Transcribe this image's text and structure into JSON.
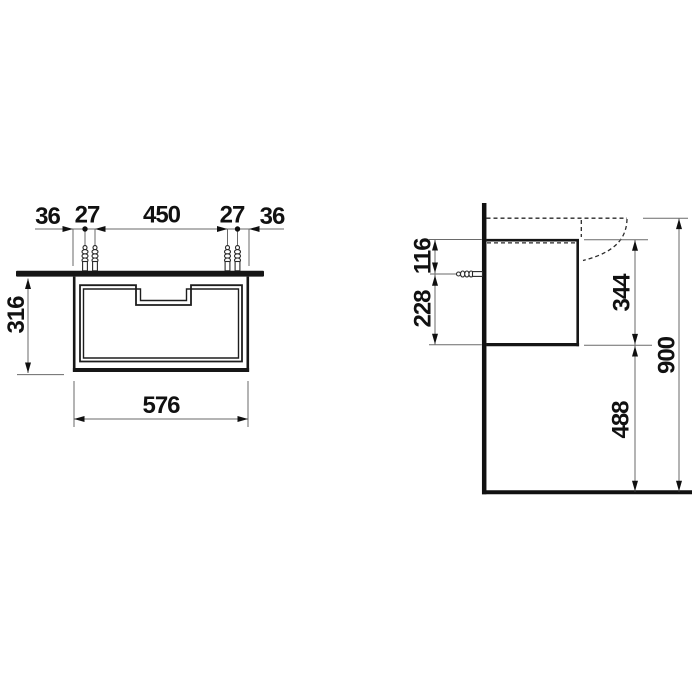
{
  "front_view": {
    "dim_left_edge_to_hole": "36",
    "dim_left_hole_pitch": "27",
    "dim_hole_span": "450",
    "dim_right_hole_pitch": "27",
    "dim_hole_to_right_edge": "36",
    "dim_height": "316",
    "dim_width": "576"
  },
  "side_view": {
    "dim_top_to_anchor": "116",
    "dim_anchor_to_bottom": "228",
    "dim_cabinet_height": "344",
    "dim_floor_clearance": "488",
    "dim_total_height": "900"
  },
  "colors": {
    "background": "#ffffff",
    "drawing_line": "#161616",
    "dimension_line": "#6a6a6a",
    "label_text": "#111111"
  }
}
